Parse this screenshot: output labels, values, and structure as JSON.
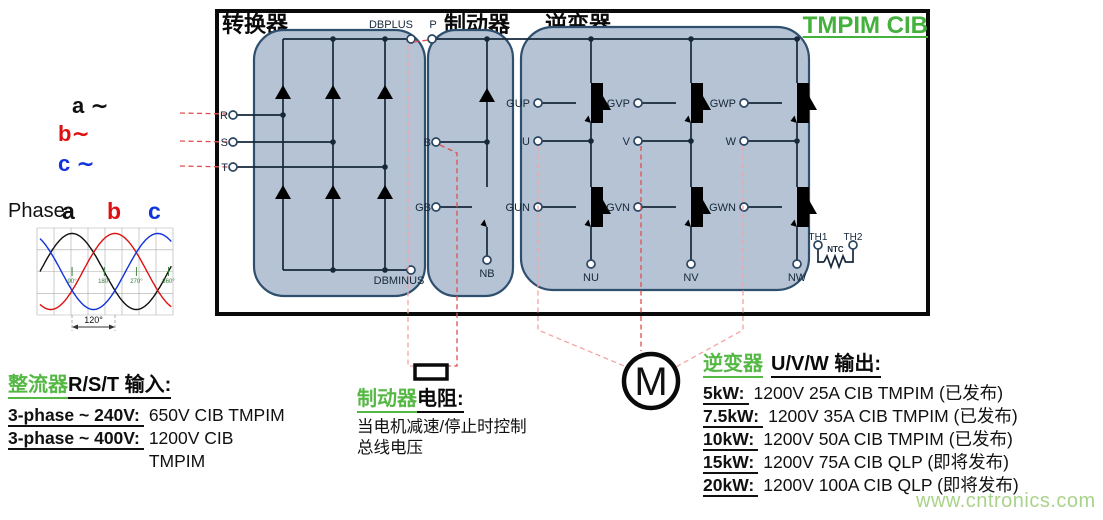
{
  "header": {
    "converter": "转换器",
    "brake": "制动器",
    "inverter": "逆变器",
    "module_title": "TMPIM CIB"
  },
  "inputs": {
    "a": "a ∼",
    "b": "b∼",
    "c": "c ∼"
  },
  "phase_plot": {
    "label": "Phase-",
    "legend_a": "a",
    "legend_b": "b",
    "legend_c": "c",
    "ticks": [
      "90°",
      "180°",
      "270°",
      "360°"
    ],
    "spacing_label": "120°",
    "theta_range_deg": [
      0,
      370
    ],
    "series": [
      {
        "name": "a",
        "color": "#111111",
        "phase_deg": 0
      },
      {
        "name": "b",
        "color": "#dd1111",
        "phase_deg": -120
      },
      {
        "name": "c",
        "color": "#1133dd",
        "phase_deg": 120
      }
    ]
  },
  "terminals": {
    "dbplus": "DBPLUS",
    "dbminus": "DBMINUS",
    "p": "P",
    "r": "R",
    "s": "S",
    "t": "T",
    "b": "B",
    "gb": "GB",
    "nb": "NB",
    "gup": "GUP",
    "gvp": "GVP",
    "gwp": "GWP",
    "u": "U",
    "v": "V",
    "w": "W",
    "gun": "GUN",
    "gvn": "GVN",
    "gwn": "GWN",
    "nu": "NU",
    "nv": "NV",
    "nw": "NW",
    "th1": "TH1",
    "th2": "TH2",
    "ntc": "NTC"
  },
  "motor": {
    "label": "M"
  },
  "annotations": {
    "rectifier": {
      "title_green": "整流器",
      "title_black": "R/S/T 输入:",
      "rows": [
        {
          "label": "3-phase ~ 240V:",
          "value": "650V CIB TMPIM"
        },
        {
          "label": "3-phase ~ 400V:",
          "value": "1200V CIB\nTMPIM"
        }
      ]
    },
    "brake": {
      "title_green": "制动器",
      "title_black": "电阻:",
      "body": "当电机减速/停止时控制\n总线电压"
    },
    "inverter": {
      "title_green": "逆变器",
      "title_black": "U/V/W 输出:",
      "rows": [
        {
          "label": "5kW:",
          "value": "1200V 25A CIB TMPIM (已发布)"
        },
        {
          "label": "7.5kW:",
          "value": "1200V 35A CIB TMPIM (已发布)"
        },
        {
          "label": "10kW:",
          "value": "1200V 50A CIB TMPIM (已发布)"
        },
        {
          "label": "15kW:",
          "value": "1200V 75A CIB QLP (即将发布)"
        },
        {
          "label": "20kW:",
          "value": "1200V 100A CIB QLP (即将发布)"
        }
      ]
    }
  },
  "watermark": "www.cntronics.com",
  "colors": {
    "accent_green": "#43b13c",
    "phase_b_red": "#dd1111",
    "phase_c_blue": "#1133dd",
    "module_fill": "#b5c3d4",
    "module_stroke": "#2f4f6e",
    "circuit_line": "#16283a",
    "dashed_red": "#e04f4f",
    "watermark_green": "#a9d38a"
  }
}
